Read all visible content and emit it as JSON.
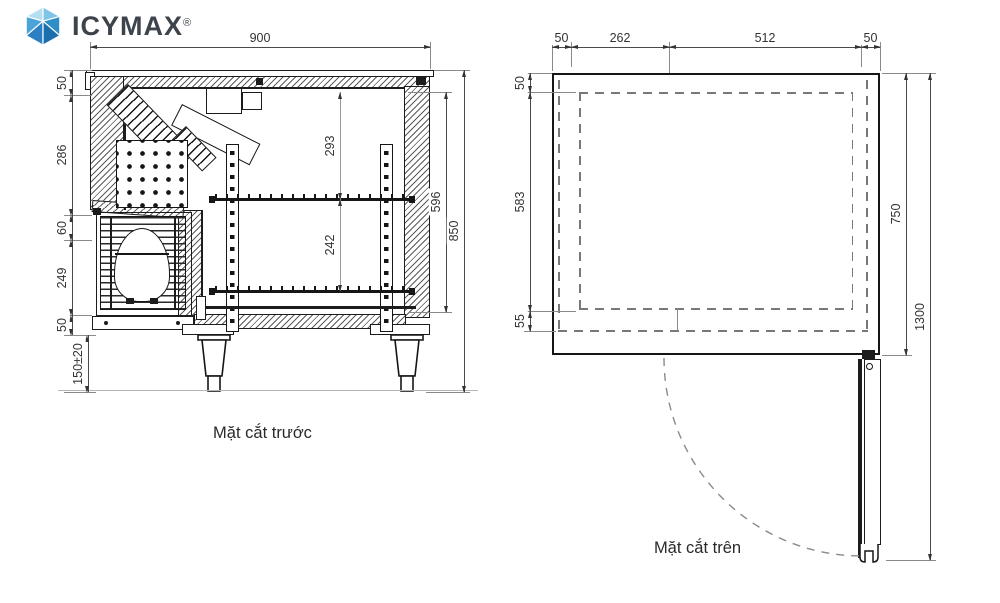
{
  "logo": {
    "brand_primary": "ICY",
    "brand_secondary": "MAX",
    "registered": "®"
  },
  "front_view": {
    "caption": "Mặt cắt trước",
    "width_dim": "900",
    "left_dims": [
      "50",
      "286",
      "60",
      "249",
      "50",
      "150±20"
    ],
    "inner_dims": [
      "293",
      "242"
    ],
    "right_dims": [
      "596",
      "850"
    ]
  },
  "top_view": {
    "caption": "Mặt cắt trên",
    "top_dims": [
      "50",
      "262",
      "512",
      "50"
    ],
    "left_dims": [
      "50",
      "583",
      "55"
    ],
    "right_dims": [
      "750",
      "1300"
    ]
  },
  "colors": {
    "line": "#1c1c1c",
    "dim_text": "#333333",
    "dashed": "#787878",
    "logo_text": "#3d434b",
    "logo_blue_light": "#b5def1",
    "logo_blue_mid": "#7fc4e8",
    "logo_blue": "#4ba3d8",
    "logo_blue_dark": "#1c6fad"
  }
}
